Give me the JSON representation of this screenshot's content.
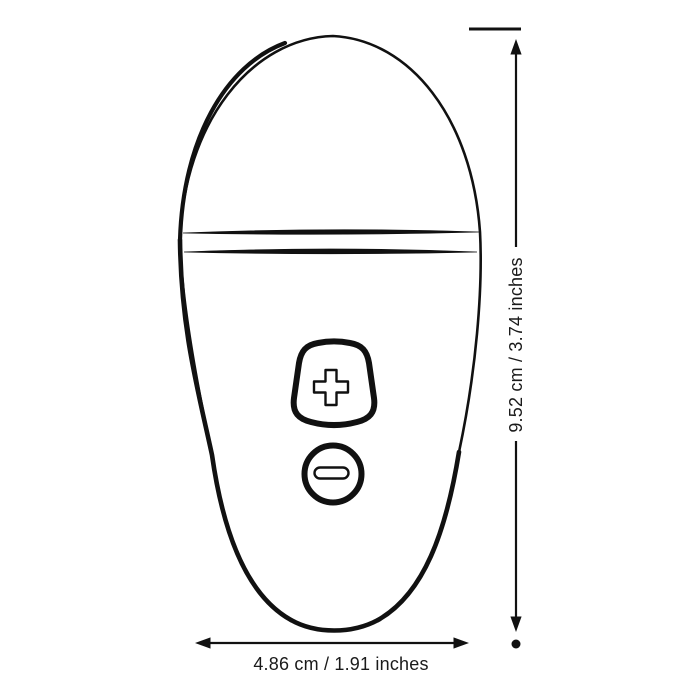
{
  "diagram": {
    "type": "product-dimension-diagram",
    "dimensions": {
      "height_label": "9.52 cm / 3.74 inches",
      "width_label": "4.86 cm / 1.91 inches"
    },
    "device": {
      "description": "egg-shaped handheld device, front view, line drawing",
      "buttons": [
        {
          "name": "increase-button",
          "symbol": "+"
        },
        {
          "name": "decrease-button",
          "symbol": "−"
        }
      ]
    },
    "colors": {
      "ink": "#111111",
      "background": "#ffffff",
      "label_text": "#1a1a1a"
    }
  }
}
